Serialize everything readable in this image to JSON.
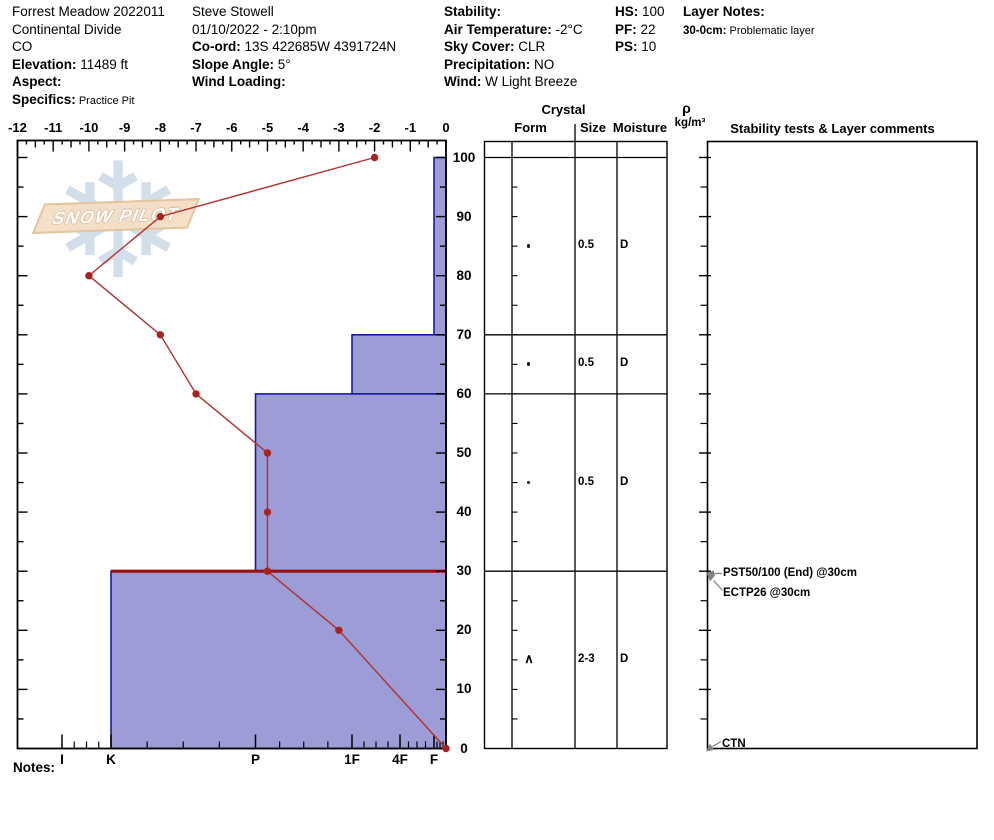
{
  "header": {
    "columns": [
      {
        "name": "location",
        "x": 12,
        "lines": [
          {
            "label": "",
            "value": "Forrest Meadow 2022011"
          },
          {
            "label": "",
            "value": "Continental Divide"
          },
          {
            "label": "",
            "value": "CO"
          },
          {
            "label": "Elevation:",
            "value": "11489 ft"
          },
          {
            "label": "Aspect:",
            "value": ""
          },
          {
            "label": "Specifics:",
            "value": "Practice Pit",
            "small": true
          }
        ]
      },
      {
        "name": "observer",
        "x": 192,
        "lines": [
          {
            "label": "",
            "value": "Steve Stowell"
          },
          {
            "label": "",
            "value": "01/10/2022 - 2:10pm"
          },
          {
            "label": "Co-ord:",
            "value": "13S 422685W 4391724N"
          },
          {
            "label": "Slope Angle:",
            "value": "5°"
          },
          {
            "label": "Wind Loading:",
            "value": ""
          }
        ]
      },
      {
        "name": "conditions",
        "x": 444,
        "lines": [
          {
            "label": "Stability:",
            "value": ""
          },
          {
            "label": "Air Temperature:",
            "value": "-2°C"
          },
          {
            "label": "Sky Cover:",
            "value": "CLR"
          },
          {
            "label": "Precipitation:",
            "value": "NO"
          },
          {
            "label": "Wind:",
            "value": "W Light Breeze"
          }
        ]
      },
      {
        "name": "measurements",
        "x": 615,
        "lines": [
          {
            "label": "HS:",
            "value": "100"
          },
          {
            "label": "PF:",
            "value": "22"
          },
          {
            "label": "PS:",
            "value": "10"
          }
        ]
      },
      {
        "name": "layer-notes",
        "x": 683,
        "lines": [
          {
            "label": "Layer Notes:",
            "value": ""
          },
          {
            "label": "30-0cm:",
            "value": "Problematic layer",
            "small": true,
            "small_label": true
          }
        ]
      }
    ]
  },
  "watermark": {
    "text": "SNOW PILOT",
    "icon": "snowflake-icon"
  },
  "notes_label": "Notes:",
  "table_headers": {
    "crystal": "Crystal",
    "form": "Form",
    "size": "Size",
    "moisture": "Moisture",
    "rho": "ρ",
    "rho_units": "kg/m³",
    "stability": "Stability tests & Layer comments"
  },
  "chart_data": {
    "type": "snow-profile",
    "temp_axis": {
      "unit": "°C",
      "min": -12,
      "max": 0,
      "tick_labels": [
        "-12",
        "-11",
        "-10",
        "-9",
        "-8",
        "-7",
        "-6",
        "-5",
        "-4",
        "-3",
        "-2",
        "-1",
        "0"
      ]
    },
    "depth_axis": {
      "unit": "cm",
      "min": 0,
      "max": 100,
      "tick_labels": [
        "100",
        "90",
        "80",
        "70",
        "60",
        "50",
        "40",
        "30",
        "20",
        "10",
        "0"
      ]
    },
    "hardness_axis": {
      "labels": [
        "I",
        "K",
        "P",
        "1F",
        "4F",
        "F"
      ],
      "x_px": [
        62,
        111,
        255.5,
        352,
        400,
        434
      ]
    },
    "layers": [
      {
        "top_cm": 100,
        "bottom_cm": 70,
        "hardness": "F",
        "problematic": false
      },
      {
        "top_cm": 70,
        "bottom_cm": 60,
        "hardness": "1F",
        "problematic": false
      },
      {
        "top_cm": 60,
        "bottom_cm": 30,
        "hardness": "P",
        "problematic": false
      },
      {
        "top_cm": 30,
        "bottom_cm": 0,
        "hardness": "K",
        "problematic": true
      }
    ],
    "temperature_profile": [
      {
        "depth_cm": 100,
        "temp_c": -2
      },
      {
        "depth_cm": 90,
        "temp_c": -8
      },
      {
        "depth_cm": 80,
        "temp_c": -10
      },
      {
        "depth_cm": 70,
        "temp_c": -8
      },
      {
        "depth_cm": 60,
        "temp_c": -7
      },
      {
        "depth_cm": 50,
        "temp_c": -5
      },
      {
        "depth_cm": 40,
        "temp_c": -5
      },
      {
        "depth_cm": 30,
        "temp_c": -5
      },
      {
        "depth_cm": 20,
        "temp_c": -3
      },
      {
        "depth_cm": 0,
        "temp_c": 0
      }
    ],
    "grain_rows": [
      {
        "layer": "100-70cm",
        "form_symbol": "•",
        "size": "0.5",
        "moisture": "D",
        "center_depth_cm": 85
      },
      {
        "layer": "70-60cm",
        "form_symbol": "•",
        "size": "0.5",
        "moisture": "D",
        "center_depth_cm": 65
      },
      {
        "layer": "60-30cm",
        "form_symbol": "•",
        "size": "0.5",
        "moisture": "D",
        "center_depth_cm": 45
      },
      {
        "layer": "30-0cm",
        "form_symbol": "∧",
        "size": "2-3",
        "moisture": "D",
        "center_depth_cm": 15
      }
    ],
    "stability_tests": [
      {
        "text": "PST50/100 (End) @30cm",
        "depth_cm": 30
      },
      {
        "text": "ECTP26 @30cm",
        "depth_cm": 30
      },
      {
        "text": "CTN",
        "depth_cm": 0
      }
    ],
    "colors": {
      "layer_fill": "#9c9cd6",
      "layer_border": "#1b1b9e",
      "temp_line": "#b23030",
      "temp_marker": "#a82222",
      "problem_line": "#991111",
      "axis": "#000000",
      "arrow_gray": "#828282"
    }
  }
}
